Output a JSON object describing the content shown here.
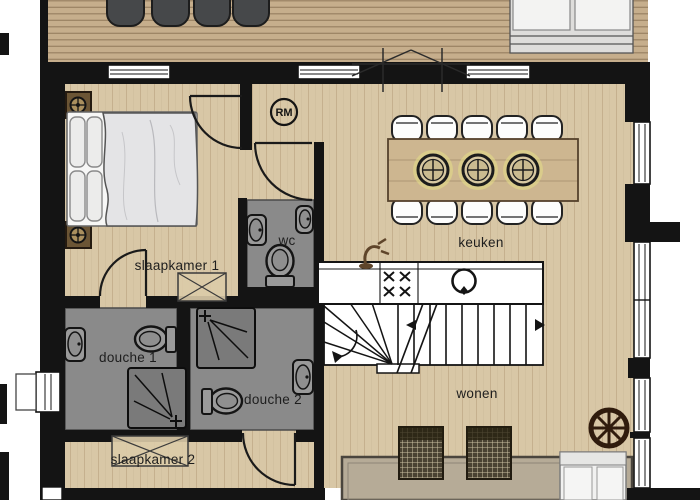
{
  "labels": {
    "slaapkamer_1": "slaapkamer 1",
    "wc": "wc",
    "keuken": "keuken",
    "douche_1": "douche 1",
    "douche_2": "douche 2",
    "slaapkamer_2": "slaapkamer 2",
    "wonen": "wonen",
    "smoke_detector": "RM"
  },
  "colors": {
    "wall": "#141414",
    "deck_wood": "#c6ae8c",
    "interior_wood": "#d8c7a6",
    "bathroom_floor": "#8a8a8a",
    "shower_tray": "#7a7a7a",
    "rug": "#b6ab97",
    "woven_chair": "#4a4232",
    "nightstand_brown": "#6b5535",
    "wheel_brown": "#301c0d",
    "lamp_glow": "#e8e186",
    "counter_white": "#ffffff"
  },
  "symbols": [
    "bed",
    "pillow",
    "nightstand-lamp",
    "wardrobe-cross",
    "toilet",
    "wall-sink",
    "shower-tray",
    "dining-table",
    "pendant-lamp",
    "dining-chair",
    "cooktop-burner-x",
    "kitchen-round-sink",
    "kitchen-faucet",
    "stair-winder",
    "stair-direction-arrow",
    "rug",
    "woven-lounge-chair",
    "sofa",
    "deck-lounge-set",
    "deck-chair",
    "wagon-wheel",
    "smoke-detector-rm",
    "door-swing",
    "window"
  ]
}
